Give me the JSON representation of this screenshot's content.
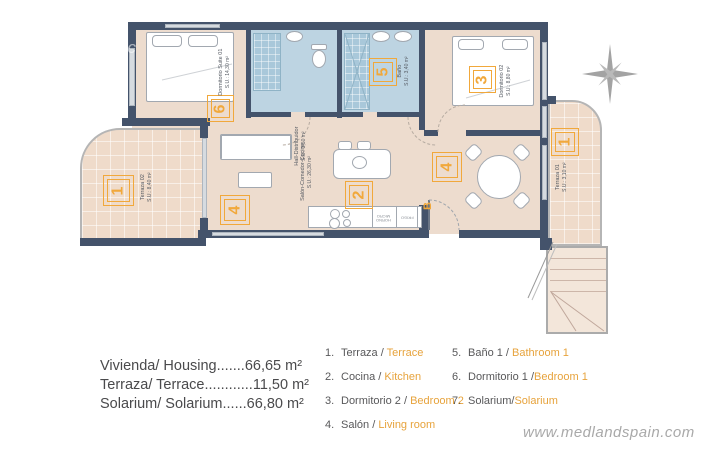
{
  "colors": {
    "wall": "#44536b",
    "floor": "#eddcce",
    "bathroom": "#bdd4e2",
    "terrace": "#efdbca",
    "accent": "#f1a83b",
    "legend_orange": "#e7a33c"
  },
  "plan": {
    "watermark_fragment": "oc",
    "suite": {
      "name": "Dormitorio Suite 01",
      "area": "S.U.: 14,30 m²",
      "tag": "6"
    },
    "bano": {
      "name": "Baño",
      "area": "S.U.: 3,40 m²",
      "tag": "5"
    },
    "dorm2": {
      "name": "Dormitorio 02",
      "area": "S.U.: 8,80 m²",
      "tag": "3"
    },
    "hall": {
      "name": "Hall-Distribuidor",
      "area": "S.U.: 3,50 m²"
    },
    "salon": {
      "name": "Salón-Comedor-Cocina",
      "area": "S.U.: 26,30 m²",
      "tag_cocina": "2",
      "tag_salon_left": "4",
      "tag_salon_right": "4"
    },
    "terraza02": {
      "name": "Terraza 02",
      "area": "S.U.: 8,40 m²",
      "tag": "1"
    },
    "terraza01": {
      "name": "Terraza 01",
      "area": "S.U.: 3,10 m²",
      "tag": "1"
    },
    "entry_tag": "B",
    "kitchen": {
      "horno": "HORNO",
      "micro": "MICRO",
      "frigo": "FRIGO"
    }
  },
  "summary": {
    "lines": [
      "Vivienda/ Housing.......66,65 m²",
      "Terraza/ Terrace............11,50 m²",
      "Solarium/ Solarium......66,80 m²"
    ]
  },
  "legend": {
    "col1": [
      {
        "num": "1.",
        "es": "Terraza",
        "sep": " / ",
        "en": "Terrace"
      },
      {
        "num": "2.",
        "es": "Cocina",
        "sep": " / ",
        "en": "Kitchen"
      },
      {
        "num": "3.",
        "es": "Dormitorio 2",
        "sep": " / ",
        "en": "Bedroom 2"
      },
      {
        "num": "4.",
        "es": "Salón",
        "sep": " / ",
        "en": "Living room"
      }
    ],
    "col2": [
      {
        "num": "5.",
        "es": "Baño 1",
        "sep": " / ",
        "en": "Bathroom 1"
      },
      {
        "num": "6.",
        "es": "Dormitorio 1",
        "sep": " /",
        "en": "Bedroom 1"
      },
      {
        "num": "7.",
        "es": "Solarium",
        "sep": "/",
        "en": "Solarium"
      }
    ]
  },
  "watermark": "www.medlandspain.com"
}
